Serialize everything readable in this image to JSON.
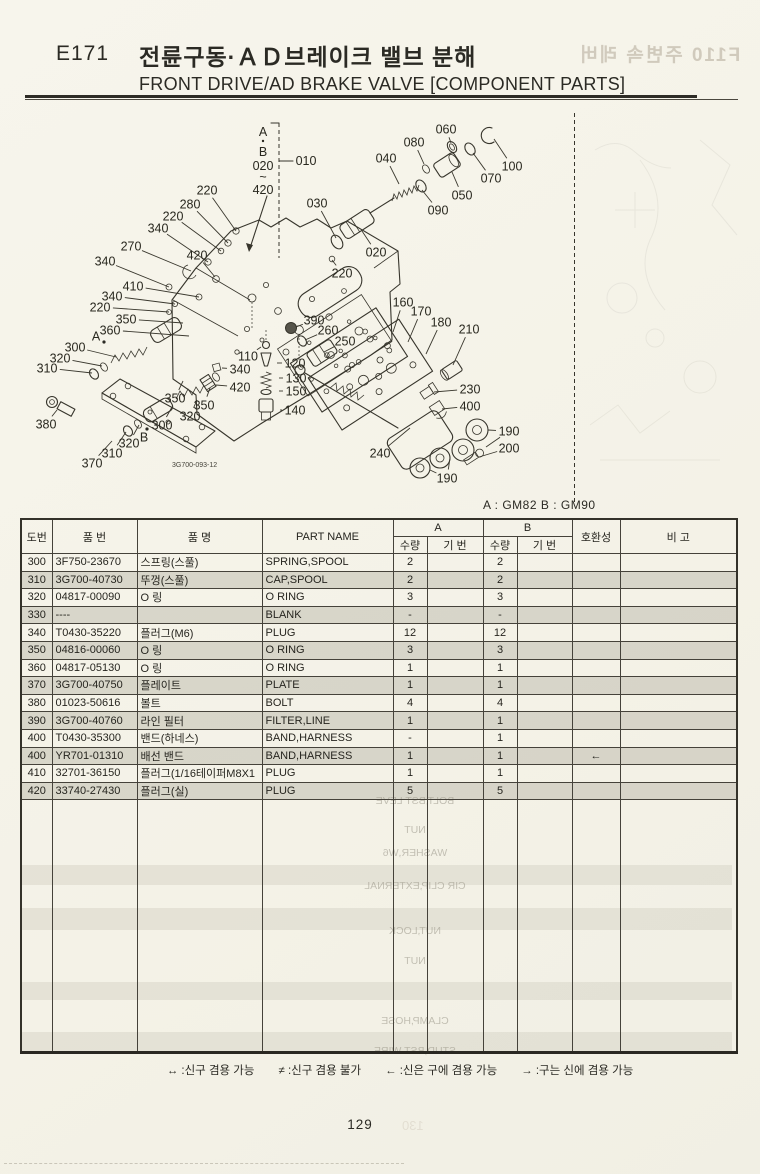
{
  "page": {
    "code": "E171",
    "title_kr": "전륜구동·ＡＤ브레이크 밸브 분해",
    "title_en": "FRONT DRIVE/AD BRAKE VALVE [COMPONENT PARTS]",
    "variant_note": "A : GM82   B : GM90",
    "drawing_number": "3G700-093-12",
    "page_number": "129",
    "ghost_page_number": "130",
    "ghost_header": "F110  주변속 레버"
  },
  "diagram": {
    "bracket": {
      "a": "A",
      "b": "B",
      "from": "020",
      "tilde": "~",
      "to": "420",
      "ref": "010"
    },
    "callouts": [
      {
        "t": "220",
        "x": 207,
        "y": 190,
        "lx": 236,
        "ly": 231
      },
      {
        "t": "280",
        "x": 190,
        "y": 204,
        "lx": 228,
        "ly": 243
      },
      {
        "t": "220",
        "x": 173,
        "y": 216,
        "lx": 221,
        "ly": 251
      },
      {
        "t": "340",
        "x": 158,
        "y": 228,
        "lx": 208,
        "ly": 262
      },
      {
        "t": "270",
        "x": 131,
        "y": 246,
        "lx": 191,
        "ly": 271
      },
      {
        "t": "340",
        "x": 105,
        "y": 261,
        "lx": 169,
        "ly": 287
      },
      {
        "t": "410",
        "x": 133,
        "y": 286,
        "lx": 199,
        "ly": 297
      },
      {
        "t": "340",
        "x": 112,
        "y": 296,
        "lx": 175,
        "ly": 304
      },
      {
        "t": "220",
        "x": 100,
        "y": 307,
        "lx": 169,
        "ly": 312
      },
      {
        "t": "420",
        "x": 197,
        "y": 255,
        "lx": 215,
        "ly": 277
      },
      {
        "t": "350",
        "x": 126,
        "y": 319,
        "lx": 183,
        "ly": 323
      },
      {
        "t": "360",
        "x": 110,
        "y": 330,
        "lx": 189,
        "ly": 336
      },
      {
        "t": "A",
        "x": 96,
        "y": 336,
        "lx": 104,
        "ly": 342,
        "dot": true
      },
      {
        "t": "300",
        "x": 75,
        "y": 347,
        "lx": 116,
        "ly": 357
      },
      {
        "t": "320",
        "x": 60,
        "y": 358,
        "lx": 102,
        "ly": 366
      },
      {
        "t": "310",
        "x": 47,
        "y": 368,
        "lx": 92,
        "ly": 373
      },
      {
        "t": "380",
        "x": 46,
        "y": 424,
        "lx": 57,
        "ly": 410
      },
      {
        "t": "370",
        "x": 92,
        "y": 463,
        "lx": 112,
        "ly": 441
      },
      {
        "t": "310",
        "x": 112,
        "y": 453,
        "lx": 126,
        "ly": 432
      },
      {
        "t": "320",
        "x": 129,
        "y": 443,
        "lx": 139,
        "ly": 425
      },
      {
        "t": "B",
        "x": 144,
        "y": 437,
        "lx": 147,
        "ly": 429,
        "dot": true
      },
      {
        "t": "300",
        "x": 162,
        "y": 425,
        "lx": 172,
        "ly": 407
      },
      {
        "t": "320",
        "x": 190,
        "y": 416,
        "lx": 197,
        "ly": 400
      },
      {
        "t": "350",
        "x": 175,
        "y": 398,
        "lx": 183,
        "ly": 381
      },
      {
        "t": "350",
        "x": 204,
        "y": 405,
        "lx": 210,
        "ly": 388
      },
      {
        "t": "340",
        "x": 240,
        "y": 369,
        "lx": 222,
        "ly": 368
      },
      {
        "t": "420",
        "x": 240,
        "y": 387,
        "lx": 216,
        "ly": 385
      },
      {
        "t": "030",
        "x": 317,
        "y": 203,
        "lx": 336,
        "ly": 238
      },
      {
        "t": "040",
        "x": 386,
        "y": 158,
        "lx": 399,
        "ly": 184
      },
      {
        "t": "020",
        "x": 376,
        "y": 252,
        "lx": 362,
        "ly": 231
      },
      {
        "t": "220",
        "x": 342,
        "y": 273,
        "lx": 332,
        "ly": 260
      },
      {
        "t": "090",
        "x": 438,
        "y": 210,
        "lx": 422,
        "ly": 190
      },
      {
        "t": "080",
        "x": 414,
        "y": 142,
        "lx": 424,
        "ly": 164
      },
      {
        "t": "060",
        "x": 446,
        "y": 129,
        "lx": 451,
        "ly": 143
      },
      {
        "t": "050",
        "x": 462,
        "y": 195,
        "lx": 452,
        "ly": 172
      },
      {
        "t": "070",
        "x": 491,
        "y": 178,
        "lx": 473,
        "ly": 153
      },
      {
        "t": "100",
        "x": 512,
        "y": 166,
        "lx": 494,
        "ly": 139
      },
      {
        "t": "110",
        "x": 248,
        "y": 356,
        "lx": 261,
        "ly": 347
      },
      {
        "t": "120",
        "x": 295,
        "y": 363,
        "lx": 277,
        "ly": 363
      },
      {
        "t": "130",
        "x": 296,
        "y": 378,
        "lx": 279,
        "ly": 378
      },
      {
        "t": "150",
        "x": 296,
        "y": 391,
        "lx": 279,
        "ly": 391
      },
      {
        "t": "140",
        "x": 295,
        "y": 410,
        "lx": 280,
        "ly": 410
      },
      {
        "t": "160",
        "x": 403,
        "y": 302,
        "lx": 393,
        "ly": 332
      },
      {
        "t": "170",
        "x": 421,
        "y": 311,
        "lx": 408,
        "ly": 342
      },
      {
        "t": "180",
        "x": 441,
        "y": 322,
        "lx": 426,
        "ly": 354
      },
      {
        "t": "210",
        "x": 469,
        "y": 329,
        "lx": 453,
        "ly": 365
      },
      {
        "t": "390",
        "x": 314,
        "y": 320,
        "lx": 296,
        "ly": 327
      },
      {
        "t": "260",
        "x": 328,
        "y": 330,
        "lx": 305,
        "ly": 340
      },
      {
        "t": "250",
        "x": 345,
        "y": 341,
        "lx": 324,
        "ly": 352
      },
      {
        "t": "230",
        "x": 470,
        "y": 389,
        "lx": 434,
        "ly": 392
      },
      {
        "t": "400",
        "x": 470,
        "y": 406,
        "lx": 442,
        "ly": 409
      },
      {
        "t": "190",
        "x": 509,
        "y": 431,
        "lx": 488,
        "ly": 430,
        "lx2": 486,
        "ly2": 447
      },
      {
        "t": "200",
        "x": 509,
        "y": 448,
        "lx": 479,
        "ly": 457
      },
      {
        "t": "240",
        "x": 380,
        "y": 453,
        "lx": 410,
        "ly": 428
      },
      {
        "t": "190",
        "x": 447,
        "y": 478,
        "lx": 430,
        "ly": 470,
        "lx2": 450,
        "ly2": 458
      }
    ]
  },
  "table": {
    "headers": {
      "no": "도번",
      "part_no": "품  번",
      "name_kr": "품  명",
      "part_name": "PART NAME",
      "group_a": "A",
      "group_b": "B",
      "qty": "수량",
      "serial": "기 번",
      "qty2": "수량",
      "serial2": "기 번",
      "compat": "호환성",
      "note": "비  고"
    },
    "rows": [
      {
        "no": "300",
        "part_no": "3F750-23670",
        "name_kr": "스프링(스풀)",
        "name_en": "SPRING,SPOOL",
        "a_qty": "2",
        "a_ser": "",
        "b_qty": "2",
        "b_ser": "",
        "compat": "",
        "note": "",
        "shaded": false
      },
      {
        "no": "310",
        "part_no": "3G700-40730",
        "name_kr": "뚜껑(스풀)",
        "name_en": "CAP,SPOOL",
        "a_qty": "2",
        "a_ser": "",
        "b_qty": "2",
        "b_ser": "",
        "compat": "",
        "note": "",
        "shaded": true
      },
      {
        "no": "320",
        "part_no": "04817-00090",
        "name_kr": "O 링",
        "name_en": "O RING",
        "a_qty": "3",
        "a_ser": "",
        "b_qty": "3",
        "b_ser": "",
        "compat": "",
        "note": "",
        "shaded": false
      },
      {
        "no": "330",
        "part_no": "----",
        "name_kr": "",
        "name_en": "BLANK",
        "a_qty": "-",
        "a_ser": "",
        "b_qty": "-",
        "b_ser": "",
        "compat": "",
        "note": "",
        "shaded": true
      },
      {
        "no": "340",
        "part_no": "T0430-35220",
        "name_kr": "플러그(M6)",
        "name_en": "PLUG",
        "a_qty": "12",
        "a_ser": "",
        "b_qty": "12",
        "b_ser": "",
        "compat": "",
        "note": "",
        "shaded": false
      },
      {
        "no": "350",
        "part_no": "04816-00060",
        "name_kr": "O 링",
        "name_en": "O RING",
        "a_qty": "3",
        "a_ser": "",
        "b_qty": "3",
        "b_ser": "",
        "compat": "",
        "note": "",
        "shaded": true
      },
      {
        "no": "360",
        "part_no": "04817-05130",
        "name_kr": "O 링",
        "name_en": "O RING",
        "a_qty": "1",
        "a_ser": "",
        "b_qty": "1",
        "b_ser": "",
        "compat": "",
        "note": "",
        "shaded": false
      },
      {
        "no": "370",
        "part_no": "3G700-40750",
        "name_kr": "플레이트",
        "name_en": "PLATE",
        "a_qty": "1",
        "a_ser": "",
        "b_qty": "1",
        "b_ser": "",
        "compat": "",
        "note": "",
        "shaded": true
      },
      {
        "no": "380",
        "part_no": "01023-50616",
        "name_kr": "볼트",
        "name_en": "BOLT",
        "a_qty": "4",
        "a_ser": "",
        "b_qty": "4",
        "b_ser": "",
        "compat": "",
        "note": "",
        "shaded": false
      },
      {
        "no": "390",
        "part_no": "3G700-40760",
        "name_kr": "라인 필터",
        "name_en": "FILTER,LINE",
        "a_qty": "1",
        "a_ser": "",
        "b_qty": "1",
        "b_ser": "",
        "compat": "",
        "note": "",
        "shaded": true
      },
      {
        "no": "400",
        "part_no": "T0430-35300",
        "name_kr": "밴드(하네스)",
        "name_en": "BAND,HARNESS",
        "a_qty": "-",
        "a_ser": "",
        "b_qty": "1",
        "b_ser": "",
        "compat": "",
        "note": "",
        "shaded": false
      },
      {
        "no": "400",
        "part_no": "YR701-01310",
        "name_kr": "배선 밴드",
        "name_en": "BAND,HARNESS",
        "a_qty": "1",
        "a_ser": "",
        "b_qty": "1",
        "b_ser": "",
        "compat": "←",
        "note": "",
        "shaded": true
      },
      {
        "no": "410",
        "part_no": "32701-36150",
        "name_kr": "플러그(1/16테이퍼M8X1",
        "name_en": "PLUG",
        "a_qty": "1",
        "a_ser": "",
        "b_qty": "1",
        "b_ser": "",
        "compat": "",
        "note": "",
        "shaded": false
      },
      {
        "no": "420",
        "part_no": "33740-27430",
        "name_kr": "플러그(실)",
        "name_en": "PLUG",
        "a_qty": "5",
        "a_ser": "",
        "b_qty": "5",
        "b_ser": "",
        "compat": "",
        "note": "",
        "shaded": true
      }
    ]
  },
  "footer": {
    "legend": [
      "↔ :신구 겸용 가능",
      "≠ :신구 겸용 불가",
      "← :신은 구에 겸용 가능",
      "→ :구는 신에 겸용 가능"
    ]
  },
  "ghost": {
    "lines": [
      {
        "y": 801,
        "text": "BOLT,BST LEVE"
      },
      {
        "y": 830,
        "text": "NUT"
      },
      {
        "y": 853,
        "text": "WASHER,W6"
      },
      {
        "y": 886,
        "text": "CIR CLIP,EXTERNAL"
      },
      {
        "y": 931,
        "text": "NUT,LOCK"
      },
      {
        "y": 961,
        "text": "NUT"
      },
      {
        "y": 1021,
        "text": "CLAMP,HOSE"
      },
      {
        "y": 1051,
        "text": "STUD,BST WIRE"
      }
    ],
    "strips": [
      {
        "y": 865,
        "h": 20
      },
      {
        "y": 908,
        "h": 22
      },
      {
        "y": 982,
        "h": 18
      },
      {
        "y": 1032,
        "h": 19
      }
    ]
  },
  "colors": {
    "ink": "#2b2a24",
    "paper": "#f6f4ea",
    "row_shade": "#d9d6cc",
    "ghost": "#918d7f"
  }
}
